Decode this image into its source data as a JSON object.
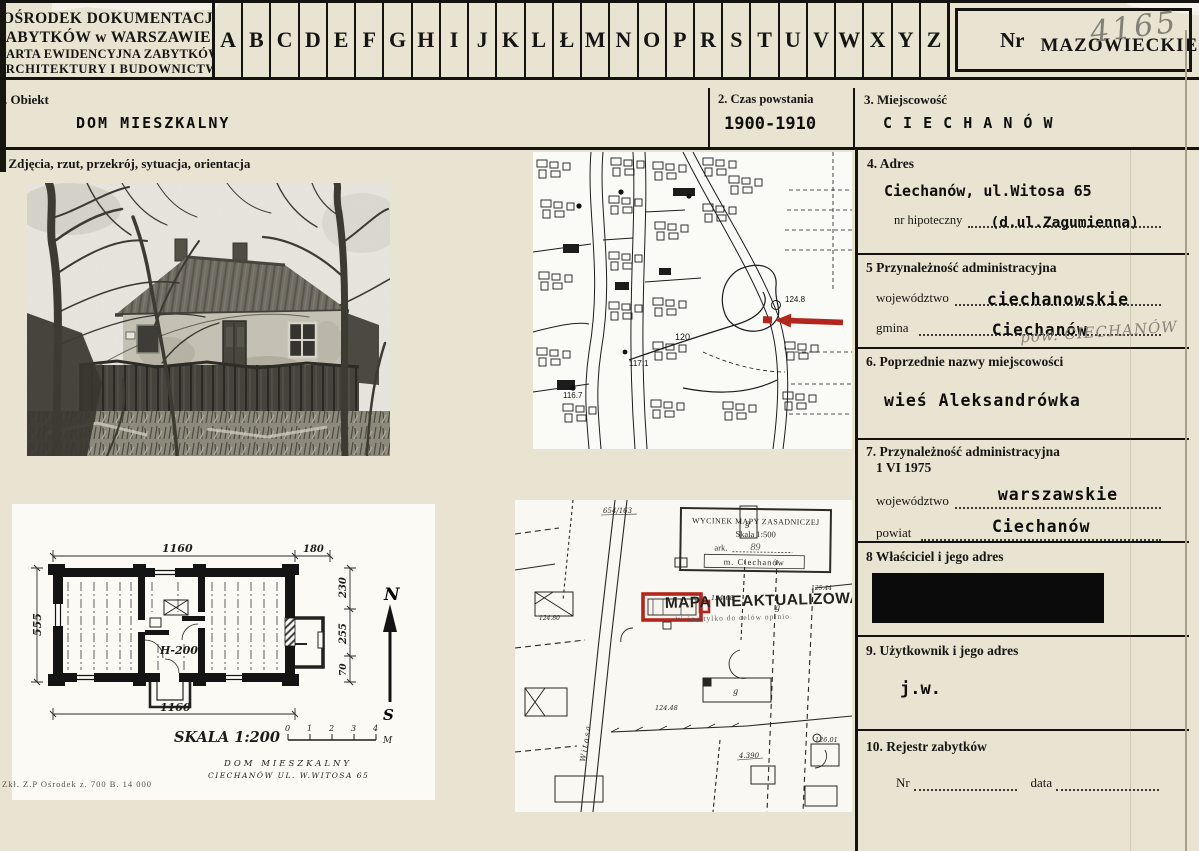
{
  "header": {
    "inst1": "OŚRODEK DOKUMENTACJI",
    "inst2": "ZABYTKÓW w WARSZAWIE",
    "inst3": "KARTA EWIDENCYJNA ZABYTKÓW",
    "inst4": "ARCHITEKTURY I BUDOWNICTWA",
    "alphabet": [
      "A",
      "B",
      "C",
      "D",
      "E",
      "F",
      "G",
      "H",
      "I",
      "J",
      "K",
      "L",
      "Ł",
      "M",
      "N",
      "O",
      "P",
      "R",
      "S",
      "T",
      "U",
      "V",
      "W",
      "X",
      "Y",
      "Z"
    ],
    "nr_label": "Nr",
    "region": "MAZOWIECKIE",
    "handwritten_number": "4165"
  },
  "row1": {
    "obiekt_label": ". Obiekt",
    "obiekt_value": "DOM MIESZKALNY",
    "czas_label": "2. Czas powstania",
    "czas_value": "1900-1910",
    "miejscowosc_label": "3. Miejscowość",
    "miejscowosc_value": "C I E C H A N Ó W"
  },
  "media_label": ". Zdjęcia, rzut, przekrój, sytuacja, orientacja",
  "right": {
    "adres": {
      "label": "4. Adres",
      "value": "Ciechanów, ul.Witosa 65",
      "hip_label": "nr hipoteczny",
      "hip_value": "(d.ul.Zagumienna)"
    },
    "admin": {
      "label": "5  Przynależność administracyjna",
      "woj_label": "województwo",
      "woj_value": "ciechanowskie",
      "gmina_label": "gmina",
      "gmina_value": "Ciechanów",
      "pencil": "pow. CIECHANÓW"
    },
    "poprzednie": {
      "label": "6. Poprzednie nazwy miejscowości",
      "value": "wieś Aleksandrówka"
    },
    "admin1975": {
      "label": "7. Przynależność administracyjna",
      "date_line": "1 VI 1975",
      "woj_label": "województwo",
      "woj_value": "warszawskie",
      "powiat_label": "powiat",
      "powiat_value": "Ciechanów"
    },
    "wlasciciel": {
      "label": "8  Właściciel i jego adres"
    },
    "uzytkownik": {
      "label": "9. Użytkownik i jego adres",
      "value": "j.w."
    },
    "rejestr": {
      "label": "10. Rejestr zabytków",
      "nr_label": "Nr",
      "data_label": "data"
    }
  },
  "plan": {
    "dim_top": "1160",
    "dim_top_right": "180",
    "dim_left": "555",
    "dim_r1": "230",
    "dim_r2": "255",
    "dim_r3": "70",
    "dim_center": "H-200",
    "dim_bottom": "1160",
    "north": "N",
    "south": "S",
    "scale": "SKALA 1:200",
    "ticks": [
      "0",
      "1",
      "2",
      "3",
      "4"
    ],
    "unit": "M",
    "caption1": "DOM MIESZKALNY",
    "caption2": "CIECHANÓW UL. W.WITOSA 65"
  },
  "map_top": {
    "c120": "120",
    "c117": "117.1",
    "c116": "116.7",
    "c124": "124.8"
  },
  "map_bottom": {
    "stamp1": "WYCINEK MAPY ZASADNICZEJ",
    "stamp2": "Skala 1:500",
    "stamp3": "ark.",
    "stamp3v": "89",
    "stamp4": "m. Ciechanów",
    "big_stamp": "MAPA NIEAKTUALIZOWANA",
    "stamp_note": "Ważna tylko do celów opinio",
    "parcel": "654/163",
    "street": "Witosa",
    "g1": "g",
    "g2": "g",
    "g3": "g",
    "n1": "124.68",
    "n2": "124.48",
    "n3": "126.01",
    "n4": "4.390",
    "n5": "125.44",
    "n6": "124.80"
  },
  "print_note": "Zkł. Z.P Ośrodek z. 700 B. 14 000",
  "colors": {
    "accent_red": "#b3261e",
    "paper": "#e9e4d1",
    "ink": "#151310"
  }
}
